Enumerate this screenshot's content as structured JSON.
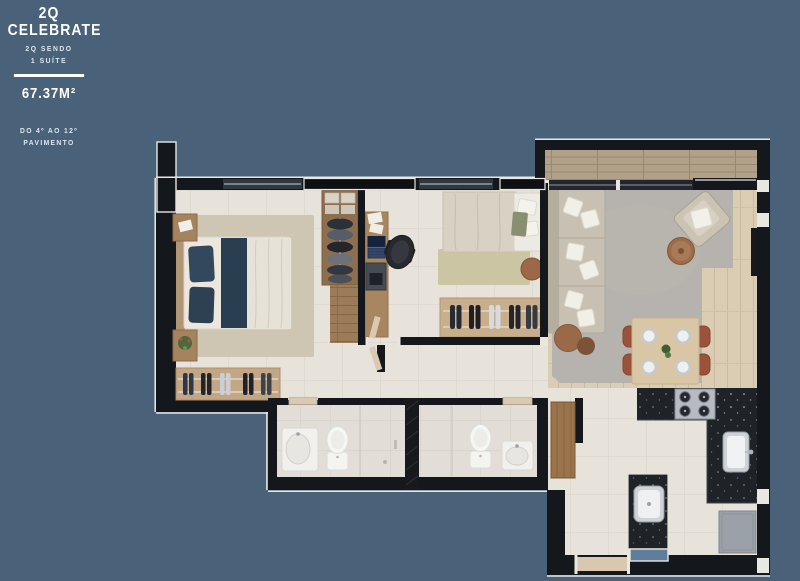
{
  "background_color": "#4a617a",
  "header": {
    "title_line1": "2Q",
    "title_line2": "CELEBRATE",
    "subtitle_line1": "2Q SENDO",
    "subtitle_line2": "1 SUÍTE",
    "area_value": "67.37M²",
    "floors_line1": "DO 4º AO 12º",
    "floors_line2": "PAVIMENTO"
  },
  "plan": {
    "wall_color": "#14171b",
    "wall_trim_color": "#e9e7e2",
    "tile_floor_color": "#e8e3da",
    "bath_tile_color": "#e2ded7",
    "living_wood_color": "#dacdb3",
    "balcony_wood_color": "#b2a189",
    "closet_wood_color": "#9c7c58",
    "living_rug_color": "#b6b2ad",
    "bedroom1_rug_color": "#cfc5b3",
    "bedroom2_rug_color": "#ccc5a4",
    "counter_color": "#1f2328",
    "door_wood_color": "#9a744d",
    "service_window_color": "#5f7e9b",
    "dining_chair_color": "#9b523b",
    "bed_pillow_color": "#33485c"
  }
}
